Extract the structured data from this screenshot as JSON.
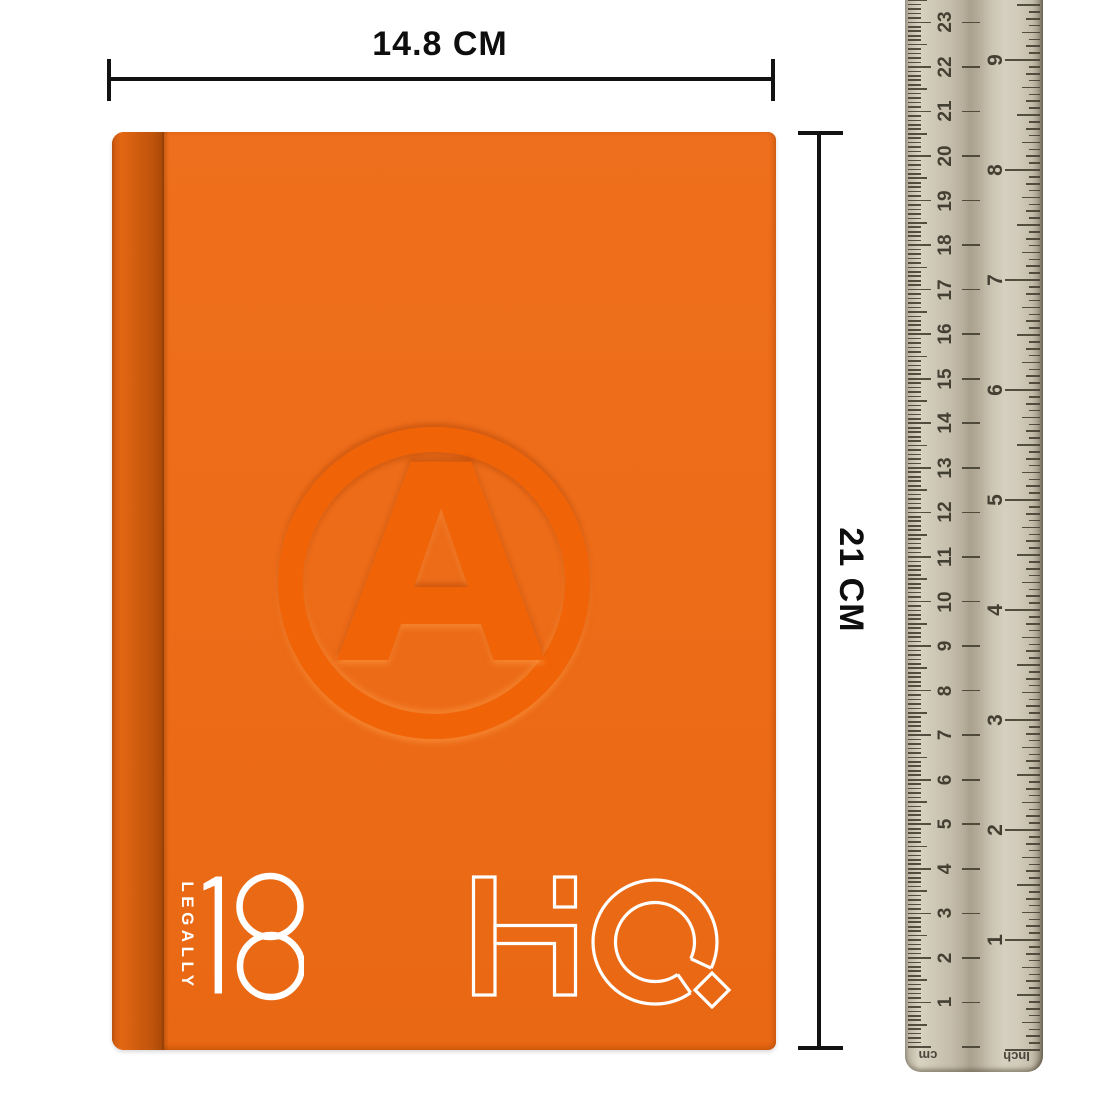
{
  "dimensions": {
    "width_label": "14.8 CM",
    "height_label": "21 CM"
  },
  "notebook": {
    "cover_color": "#ec6c18",
    "spine_color": "#c2550c",
    "emblem_color": "#f16307",
    "emblem_letter": "A",
    "spine_text": "LEGALLY",
    "edition_number": "18",
    "logo_text": "HQ",
    "text_color": "#ffffff"
  },
  "ruler": {
    "body_color": "#cdc6b5",
    "tick_color": "#484234",
    "left_unit_label": "cm",
    "right_unit_label": "Inch",
    "cm_numbers": [
      "1",
      "2",
      "3",
      "4",
      "5",
      "6",
      "7",
      "8",
      "9",
      "10",
      "11",
      "12",
      "13",
      "14",
      "15",
      "16",
      "17",
      "18",
      "19",
      "20",
      "21",
      "22",
      "23"
    ],
    "inch_numbers": [
      "1",
      "2",
      "3",
      "4",
      "5",
      "6",
      "7",
      "8",
      "9"
    ]
  },
  "annotation_color": "#121212"
}
